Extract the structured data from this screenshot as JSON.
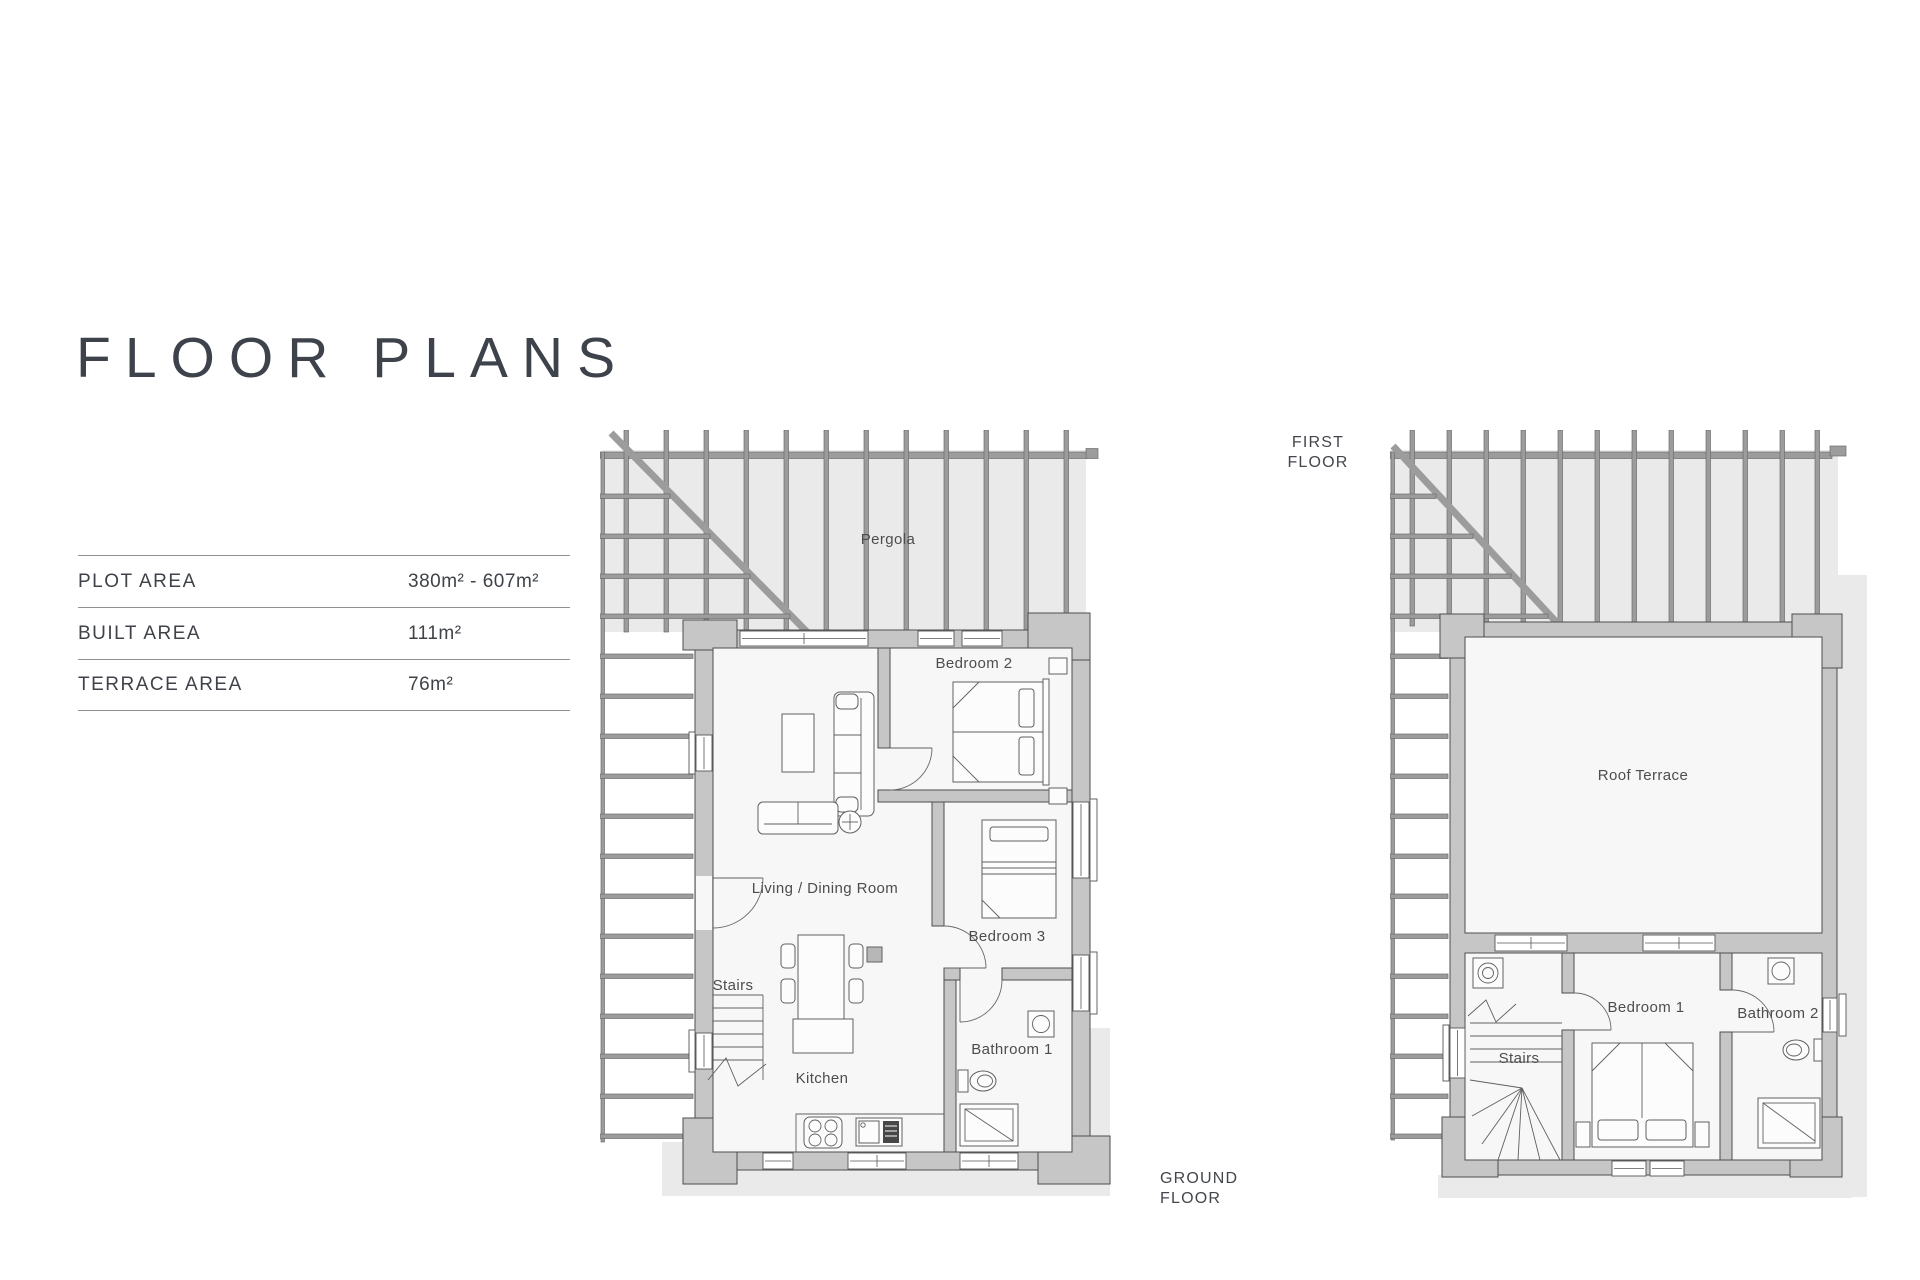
{
  "title": "FLOOR PLANS",
  "area_table": {
    "rows": [
      {
        "label": "PLOT AREA",
        "value": "380m² - 607m²"
      },
      {
        "label": "BUILT AREA",
        "value": "111m²"
      },
      {
        "label": "TERRACE AREA",
        "value": "76m²"
      }
    ]
  },
  "ground_floor": {
    "caption_line1": "GROUND",
    "caption_line2": "FLOOR",
    "labels": {
      "pergola": "Pergola",
      "bedroom2": "Bedroom 2",
      "living_dining": "Living / Dining Room",
      "bedroom3": "Bedroom 3",
      "stairs": "Stairs",
      "kitchen": "Kitchen",
      "bathroom1": "Bathroom 1"
    }
  },
  "first_floor": {
    "caption_line1": "FIRST",
    "caption_line2": "FLOOR",
    "labels": {
      "roof_terrace": "Roof Terrace",
      "bedroom1": "Bedroom 1",
      "bathroom2": "Bathroom 2",
      "stairs": "Stairs"
    }
  },
  "colors": {
    "wall": "#c6c6c6",
    "terrace": "#eaeaea",
    "slat": "#9c9c9c",
    "room_fill": "#f7f7f7",
    "heading_ink": "#3d424b",
    "label_ink": "#4d4d4d",
    "table_line": "#8f8f8f"
  }
}
